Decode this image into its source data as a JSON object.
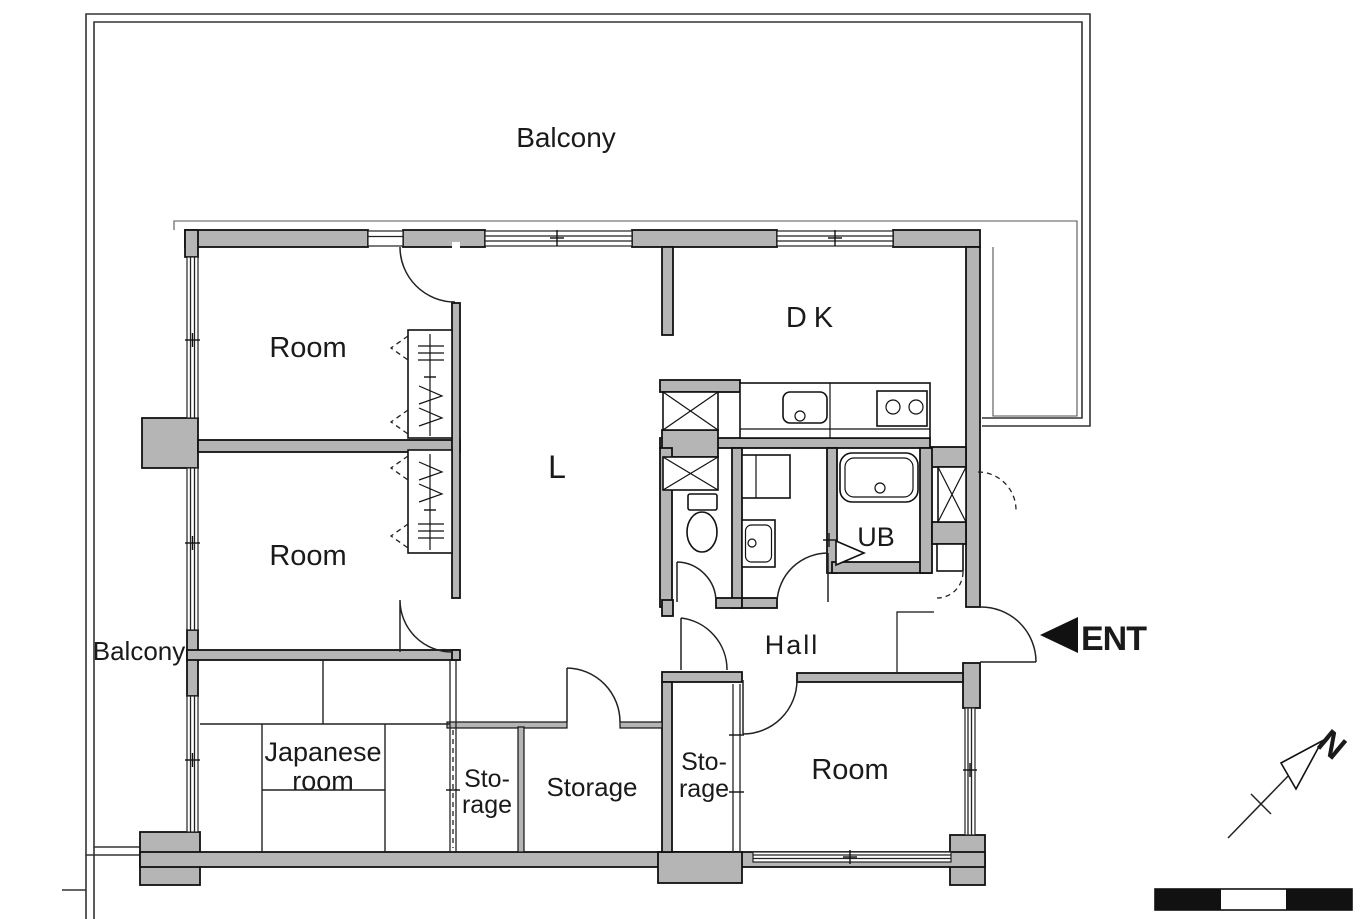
{
  "type": "floor-plan",
  "colors": {
    "wall_fill": "#b5b5b5",
    "line": "#1a1a1a",
    "background": "#ffffff",
    "entrance_arrow": "#111111"
  },
  "labels": {
    "balcony_top": "Balcony",
    "balcony_left": "Balcony",
    "room_top_left": "Room",
    "room_mid_left": "Room",
    "room_bottom_right": "Room",
    "dining_kitchen": "DK",
    "living": "L",
    "unit_bath": "UB",
    "hall": "Hall",
    "japanese_room_line1": "Japanese",
    "japanese_room_line2": "room",
    "storage_left_line1": "Sto-",
    "storage_left_line2": "rage",
    "storage_center": "Storage",
    "storage_right_line1": "Sto-",
    "storage_right_line2": "rage"
  },
  "entrance": {
    "label": "ENT"
  },
  "compass": {
    "north_label": "N"
  },
  "scale_bar": {
    "segments": [
      "black",
      "white",
      "black"
    ]
  }
}
